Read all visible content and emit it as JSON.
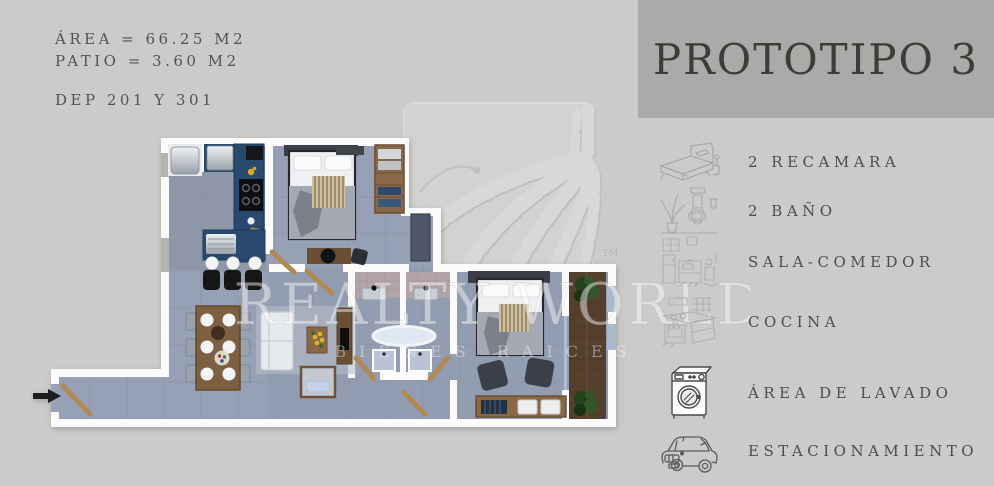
{
  "info": {
    "area": "ÁREA = 66.25 M2",
    "patio": "PATIO = 3.60 M2",
    "unit": "DEP 201 Y 301"
  },
  "header": {
    "title": "PROTOTIPO 3"
  },
  "features": [
    {
      "icon": "bed-sketch-icon",
      "label": "2 RECAMARA"
    },
    {
      "icon": "bathroom-sketch-icon",
      "label": "2 BAÑO"
    },
    {
      "icon": "kitchenette-sketch-icon",
      "label": "SALA-COMEDOR"
    },
    {
      "icon": "stove-sketch-icon",
      "label": "COCINA"
    },
    {
      "icon": "washing-machine-icon",
      "label": "ÁREA DE LAVADO"
    },
    {
      "icon": "car-icon",
      "label": "ESTACIONAMIENTO"
    }
  ],
  "watermark": {
    "brand": "REALTY WORLD",
    "tagline": "BIENES RAICES",
    "tm": "TM"
  },
  "colors": {
    "background": "#cbcbc9",
    "header_bg": "#aaaaa8",
    "title_text": "#3b3e38",
    "body_text": "#4d4d4b",
    "floor": "#97a1b5",
    "wall": "#fbfbfb",
    "kitchen_counter": "#2b4a6e",
    "wood": "#8a6847",
    "deck_wood": "#553f2d",
    "plant": "#2c4a27"
  }
}
